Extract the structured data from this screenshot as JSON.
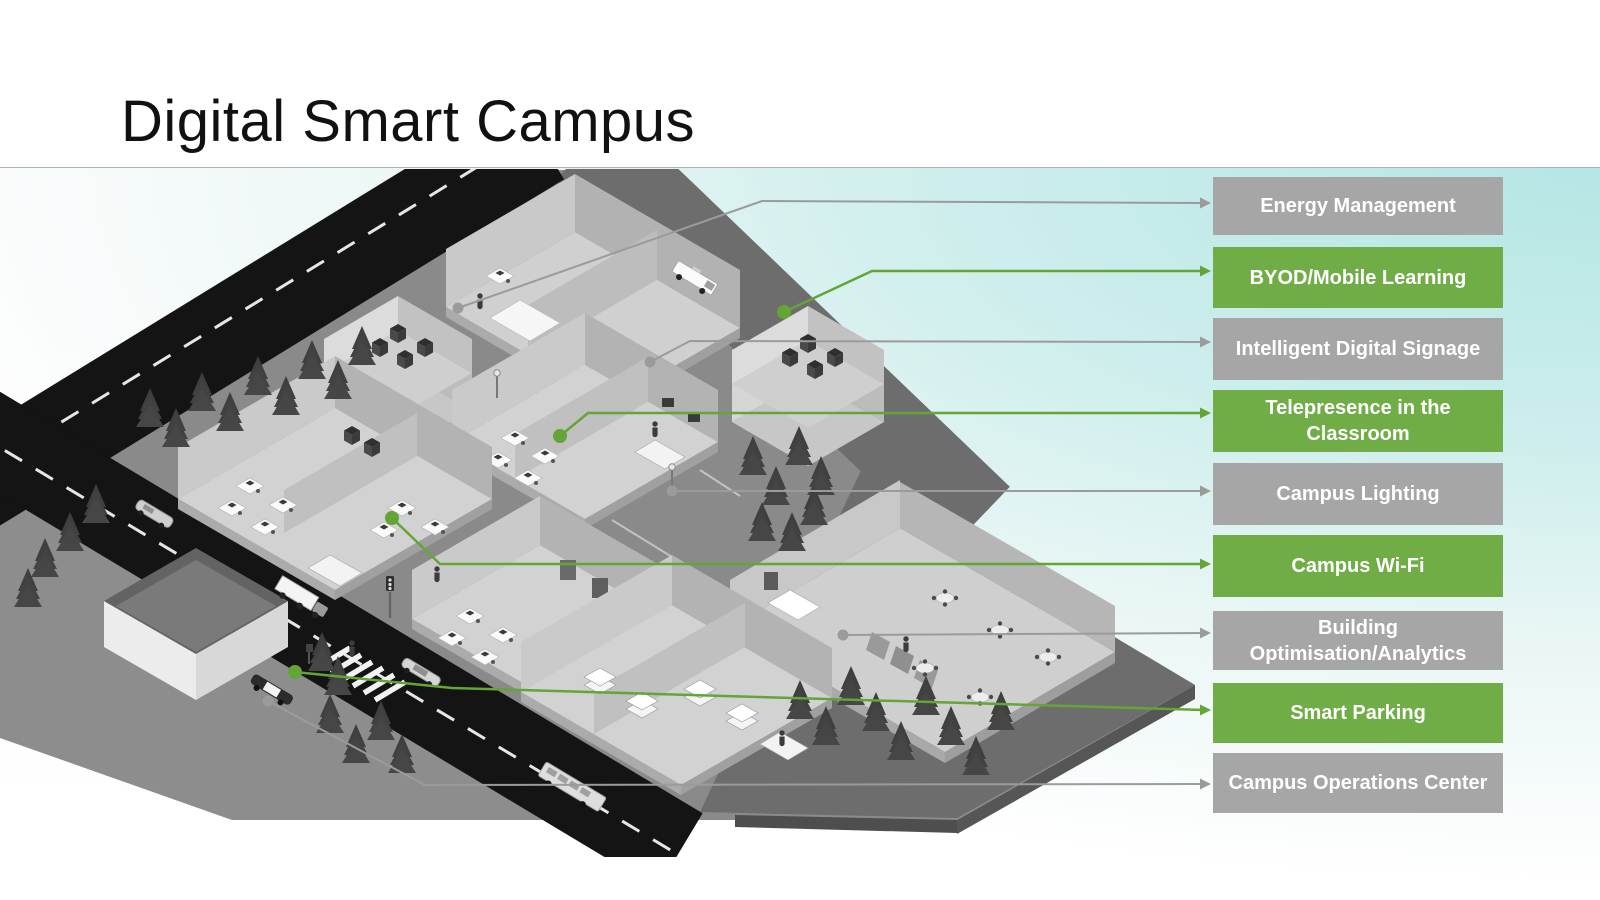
{
  "slide": {
    "title": "Digital Smart Campus"
  },
  "colors": {
    "green_box": "#70ad47",
    "gray_box": "#a6a6a6",
    "green_line": "#63a537",
    "gray_line": "#9b9b9b"
  },
  "callouts": [
    {
      "label": "Energy Management",
      "style": "gray"
    },
    {
      "label": "BYOD/Mobile Learning",
      "style": "green"
    },
    {
      "label": "Intelligent Digital Signage",
      "style": "gray"
    },
    {
      "label": "Telepresence in the Classroom",
      "style": "green"
    },
    {
      "label": "Campus Lighting",
      "style": "gray"
    },
    {
      "label": "Campus Wi-Fi",
      "style": "green"
    },
    {
      "label": "Building Optimisation/Analytics",
      "style": "gray"
    },
    {
      "label": "Smart Parking",
      "style": "green"
    },
    {
      "label": "Campus Operations Center",
      "style": "gray"
    }
  ]
}
